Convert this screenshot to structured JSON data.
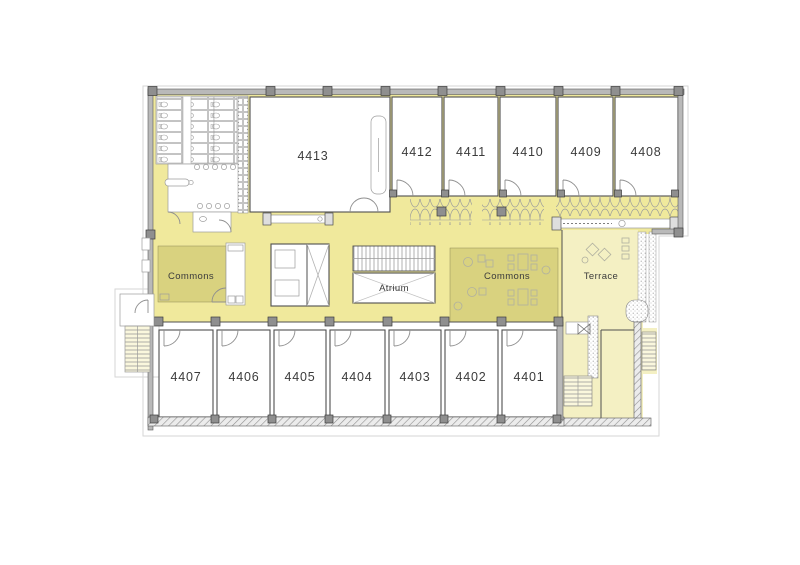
{
  "plan": {
    "rooms_top": [
      "4413",
      "4412",
      "4411",
      "4410",
      "4409",
      "4408"
    ],
    "rooms_bottom": [
      "4407",
      "4406",
      "4405",
      "4404",
      "4403",
      "4402",
      "4401"
    ],
    "areas": {
      "commons_left": "Commons",
      "commons_right": "Commons",
      "atrium": "Atrium",
      "terrace": "Terrace"
    },
    "colors": {
      "circulation": "#f0e99c",
      "commons": "#d9d27f",
      "terrace": "#f4f0c3",
      "wall": "#b9b9b9",
      "column": "#8f8f8f",
      "line": "#4f4f4f",
      "text": "#3b3b3b"
    }
  }
}
